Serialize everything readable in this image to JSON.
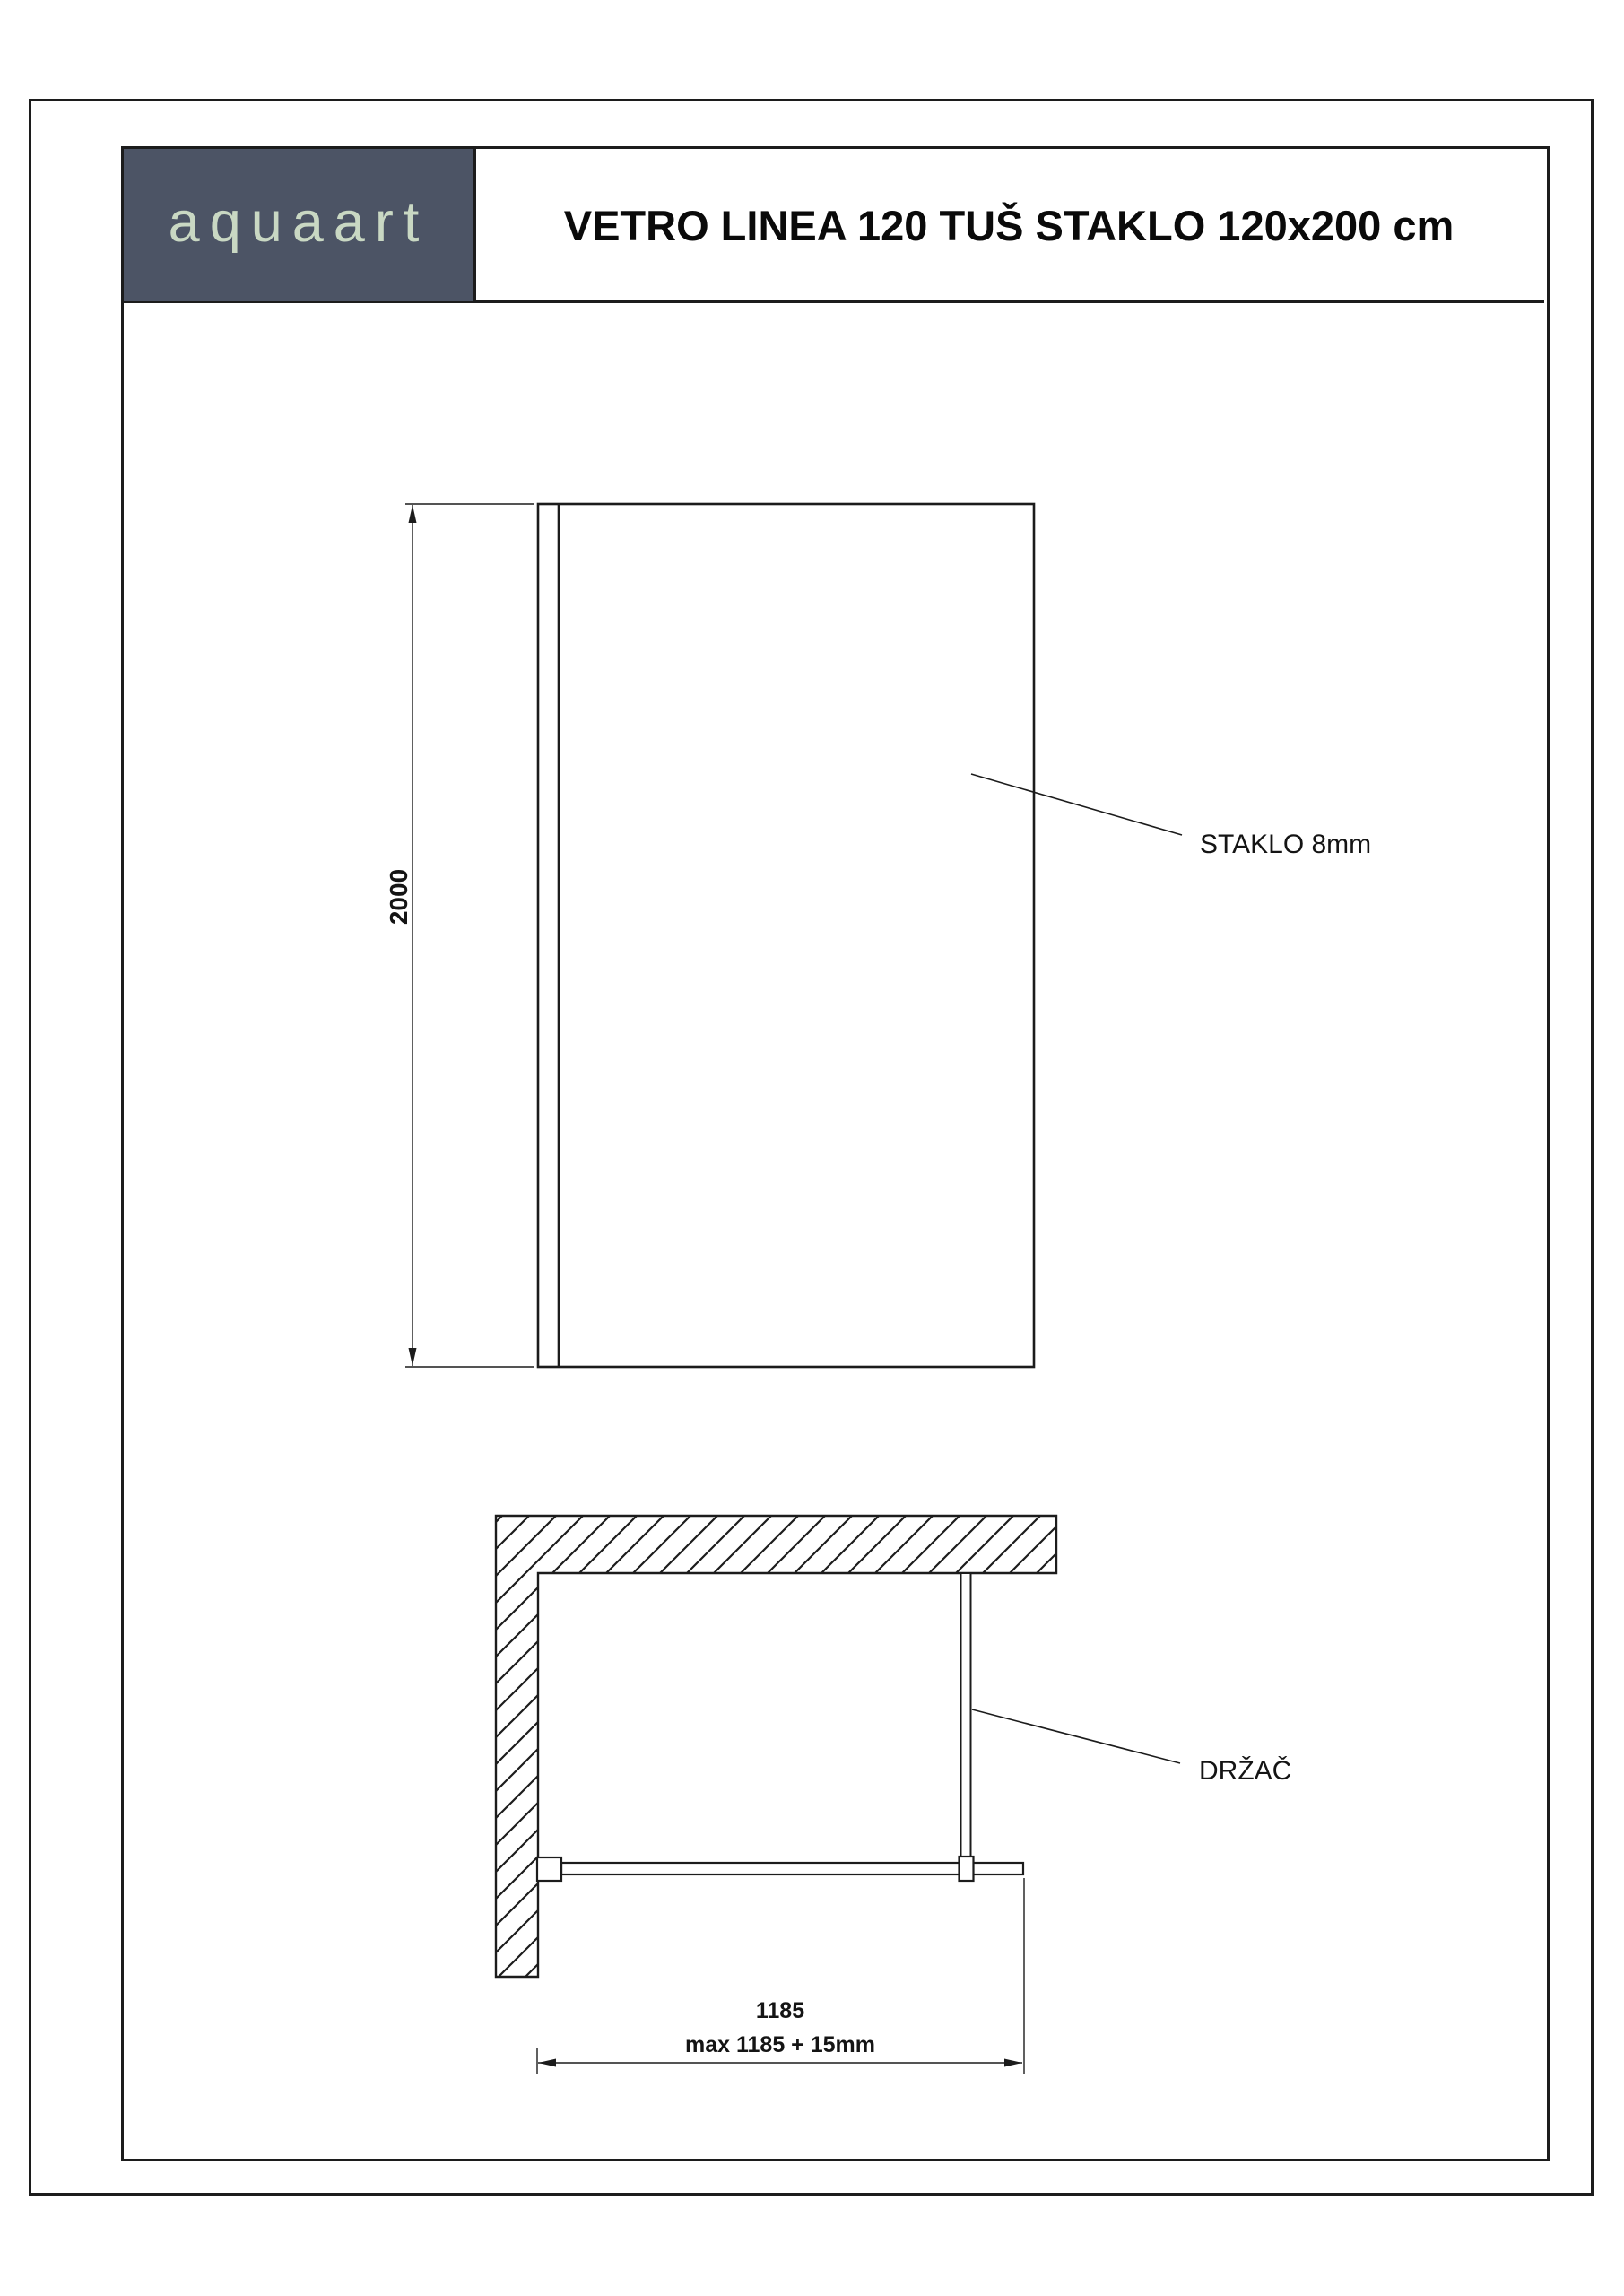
{
  "page": {
    "background": "#ffffff",
    "line_color": "#1c1c1c"
  },
  "header": {
    "logo_text": "aquaart",
    "logo_bg": "#4c5465",
    "logo_color": "#c9d8c3",
    "title": "VETRO LINEA 120 TUŠ STAKLO 120x200 cm"
  },
  "front_view": {
    "height_dimension": "2000",
    "glass_label": "STAKLO 8mm"
  },
  "top_view": {
    "holder_label": "DRŽAČ",
    "width_dimension": "1185",
    "width_max_dimension": "max 1185 + 15mm"
  }
}
